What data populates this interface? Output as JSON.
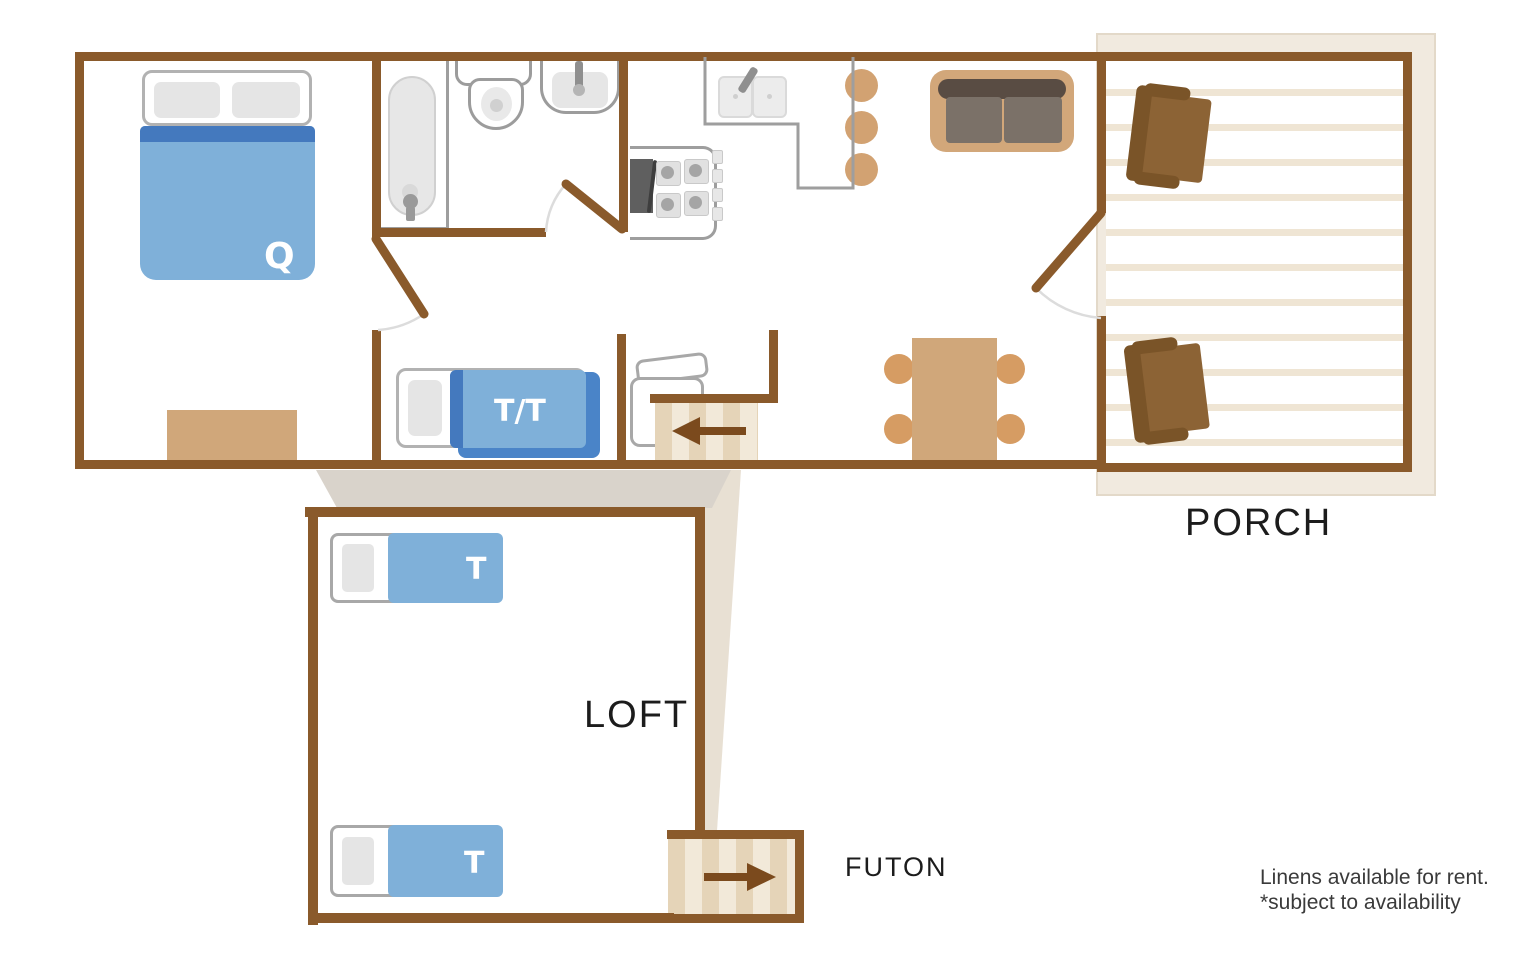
{
  "title": "Cabin Floor Plan",
  "rooms": {
    "porch_label": "PORCH",
    "loft_label": "LOFT",
    "futon_label": "FUTON"
  },
  "beds": {
    "queen_label": "Q",
    "twin_twin_label": "T/T",
    "loft_twin_upper_label": "T",
    "loft_twin_lower_label": "T"
  },
  "note": {
    "line1": "Linens available for rent.",
    "line2": "*subject to availability"
  },
  "colors": {
    "wall_brown": "#8a5a2b",
    "arrow_brown": "#7b4a1d",
    "bed_blue": "#7fb0d9",
    "bed_blue_dark": "#4479be",
    "bed_blue_under": "#4a84c8",
    "furniture_tan": "#d0a77a",
    "dining_chair_tan": "#d69c63",
    "stool_tan": "#d2a272",
    "porch_chair_brown": "#8c6335",
    "porch_chair_dark": "#7a5428",
    "sofa_back": "#594c43",
    "sofa_seat": "#7b7168",
    "deck_band": "#f1eadf",
    "deck_stripe": "#efe5d4",
    "stair_stripe_light": "#f2e9d9",
    "stair_stripe_dark": "#e5d4b8",
    "fixture_outline": "#9c9c9c",
    "shadow": "#d9d3cb",
    "shadow_light": "#e8e0d3",
    "label_black": "#1c1c1c",
    "note_gray": "#3a3a3a"
  }
}
